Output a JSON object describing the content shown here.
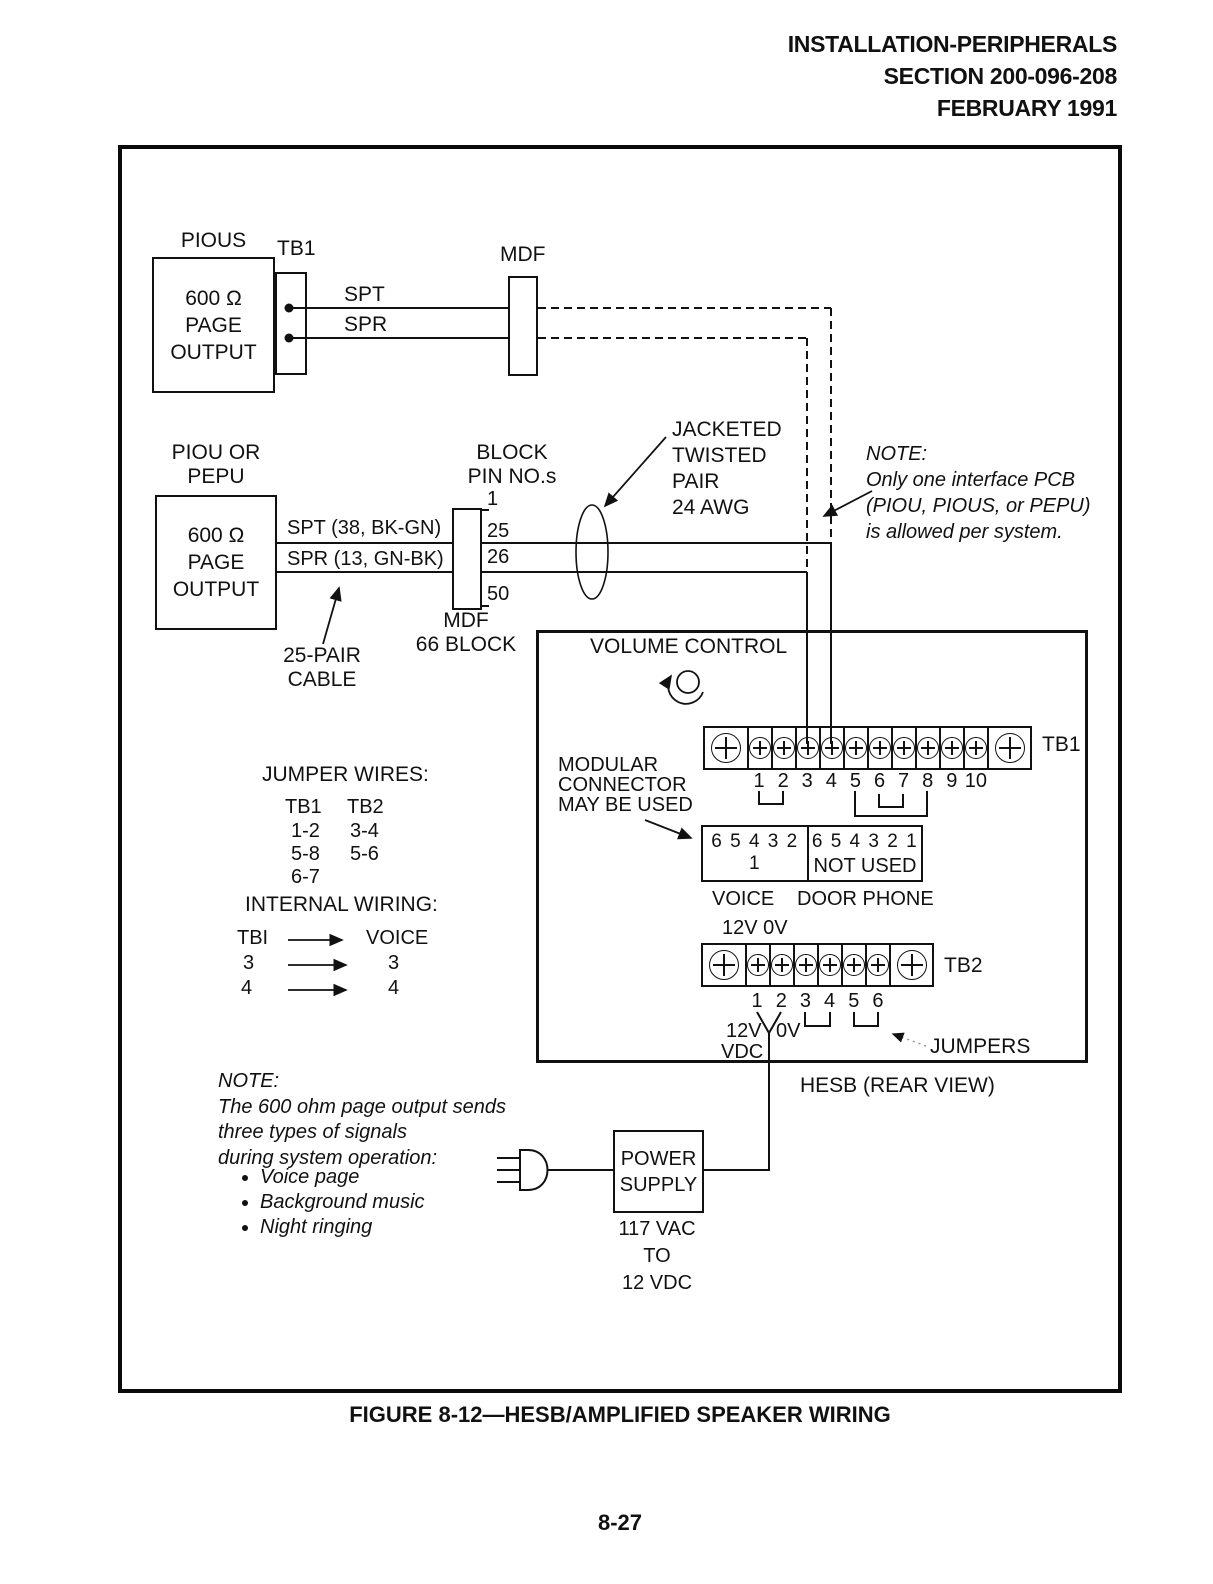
{
  "header": {
    "line1": "INSTALLATION-PERIPHERALS",
    "line2": "SECTION 200-096-208",
    "line3": "FEBRUARY 1991"
  },
  "top_circuit": {
    "pious_label": "PIOUS",
    "tb1_label": "TB1",
    "pious_box": [
      "600 Ω",
      "PAGE",
      "OUTPUT"
    ],
    "spt": "SPT",
    "spr": "SPR",
    "mdf_label": "MDF"
  },
  "mid_circuit": {
    "piou_label": [
      "PIOU OR",
      "PEPU"
    ],
    "piou_box": [
      "600 Ω",
      "PAGE",
      "OUTPUT"
    ],
    "spt": "SPT (38, BK-GN)",
    "spr": "SPR (13, GN-BK)",
    "block_heading": [
      "BLOCK",
      "PIN NO.s"
    ],
    "pins": {
      "top": "1",
      "spt": "25",
      "spr": "26",
      "bottom": "50"
    },
    "block_label": [
      "MDF",
      "66 BLOCK"
    ],
    "cable_label": [
      "25-PAIR",
      "CABLE"
    ],
    "jacketed": [
      "JACKETED",
      "TWISTED",
      "PAIR",
      "24 AWG"
    ],
    "note": {
      "title": "NOTE:",
      "lines": [
        "Only one interface PCB",
        "(PIOU, PIOUS, or PEPU)",
        "is allowed per system."
      ]
    }
  },
  "tables": {
    "jumper_wires": {
      "title": "JUMPER WIRES:",
      "headers": [
        "TB1",
        "TB2"
      ],
      "rows": [
        [
          "1-2",
          "3-4"
        ],
        [
          "5-8",
          "5-6"
        ],
        [
          "6-7",
          ""
        ]
      ]
    },
    "internal_wiring": {
      "title": "INTERNAL WIRING:",
      "rows": [
        [
          "TBI",
          "VOICE"
        ],
        [
          "3",
          "3"
        ],
        [
          "4",
          "4"
        ]
      ]
    }
  },
  "hesb": {
    "volume_control": "VOLUME CONTROL",
    "tb1": {
      "label": "TB1",
      "numbers": [
        "1",
        "2",
        "3",
        "4",
        "5",
        "6",
        "7",
        "8",
        "9",
        "10"
      ]
    },
    "modular_note": [
      "MODULAR",
      "CONNECTOR",
      "MAY BE USED"
    ],
    "connector": {
      "left_pins": "6 5 4 3 2 1",
      "right_pins": "6 5 4 3 2 1",
      "not_used": "NOT USED",
      "left_label": "VOICE",
      "right_label": "DOOR PHONE"
    },
    "tb2": {
      "label": "TB2",
      "above": "12V 0V",
      "numbers": [
        "1",
        "2",
        "3",
        "4",
        "5",
        "6"
      ],
      "v12": "12V",
      "v0": "0V",
      "vdc": "VDC"
    },
    "jumpers_label": "JUMPERS",
    "caption": "HESB (REAR VIEW)"
  },
  "note_bottom": {
    "title": "NOTE:",
    "lines": [
      "The 600 ohm page output sends",
      "three types of signals",
      "during system operation:"
    ],
    "bullets": [
      "Voice page",
      "Background music",
      "Night ringing"
    ]
  },
  "power": {
    "box": [
      "POWER",
      "SUPPLY"
    ],
    "rating": [
      "117 VAC",
      "TO",
      "12 VDC"
    ]
  },
  "figure_caption": "FIGURE 8-12—HESB/AMPLIFIED SPEAKER WIRING",
  "page_number": "8-27"
}
